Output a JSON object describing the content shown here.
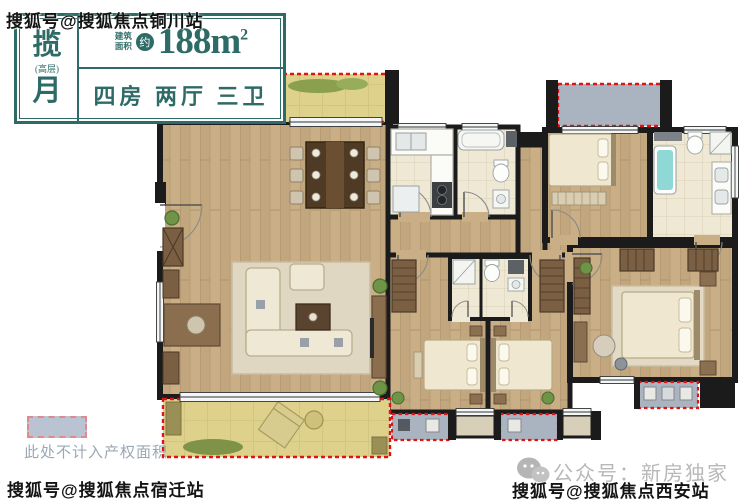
{
  "watermarks": {
    "top_left": "搜狐号@搜狐焦点铜川站",
    "bottom_left": "搜狐号@搜狐焦点宿迁站",
    "bottom_right": "搜狐号@搜狐焦点西安站"
  },
  "header": {
    "name_top": "揽",
    "name_note": "(高层)",
    "name_bottom": "月",
    "area_label_line1": "建筑",
    "area_label_line2": "面积",
    "area_badge": "约",
    "area_value": "188m",
    "area_sup": "2",
    "rooms_summary": "四房 两厅 三卫",
    "accent_color": "#2e6b66"
  },
  "legend": {
    "note": "此处不计入产权面积",
    "swatch_color": "#b9c3d2"
  },
  "footer": {
    "wechat_label": "公众号：新房独家"
  },
  "floorplan": {
    "colors": {
      "wall": "#1b1b1b",
      "wood_floor": "#c9ae86",
      "tile_floor": "#efe8d5",
      "balcony_floor": "#ddd18c",
      "equipment_platform": "#aab3c0",
      "non_property_dash": "#e01414",
      "bathtub_water": "#8ed9d6"
    },
    "areas": [
      "dining-balcony",
      "dining-room",
      "kitchen",
      "guest-bathroom",
      "hallway",
      "bedroom-top-right",
      "master-bathroom",
      "living-room",
      "south-balcony",
      "bedroom-mid-left",
      "bedroom-mid-right",
      "shared-bathroom",
      "master-bedroom",
      "equipment-platforms"
    ]
  }
}
